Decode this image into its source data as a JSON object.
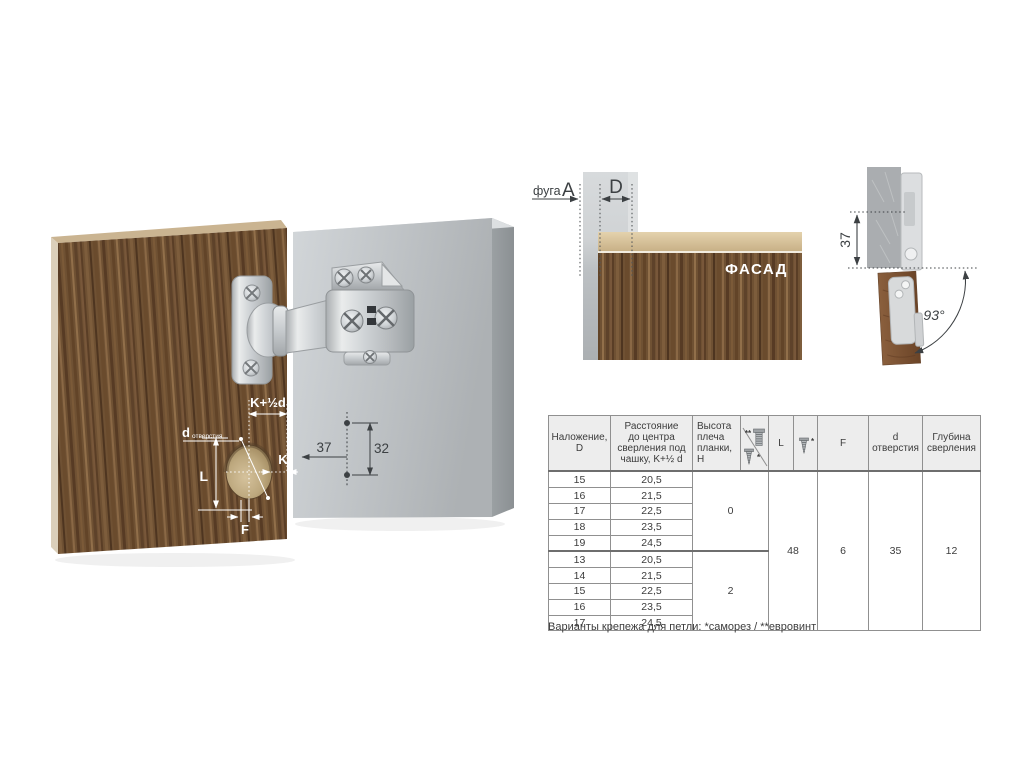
{
  "main_illustration": {
    "door_dims": {
      "k_plus_half_d": "K+½d",
      "d_label": "d",
      "d_sub": "отверстия",
      "l": "L",
      "k": "K",
      "f": "F"
    },
    "panel_dims": {
      "horizontal": "37",
      "vertical": "32"
    }
  },
  "overlay_diagram": {
    "gap_word": "фуга",
    "gap_letter": "A",
    "overlay_letter": "D",
    "facade_label": "ФАСАД"
  },
  "side_diagram": {
    "height": "37",
    "opening_angle": "93°"
  },
  "table": {
    "headers": {
      "overlay": "Наложение,\nD",
      "distance": "Расстояние\nдо центра\nсверления под\nчашку, K+½ d",
      "arm_height": "Высота\nплеча\nпланки, H",
      "l": "L",
      "f": "F",
      "hole_d": "d\nотверстия",
      "depth": "Глубина\nсверления",
      "euro_mark": "**",
      "screw_mark": "*",
      "screw_mark2": "*"
    },
    "shared": {
      "l": "48",
      "f": "6",
      "hole_d": "35",
      "depth": "12"
    },
    "groups": [
      {
        "arm_height": "0",
        "rows": [
          {
            "d": "15",
            "k": "20,5"
          },
          {
            "d": "16",
            "k": "21,5"
          },
          {
            "d": "17",
            "k": "22,5"
          },
          {
            "d": "18",
            "k": "23,5"
          },
          {
            "d": "19",
            "k": "24,5"
          }
        ]
      },
      {
        "arm_height": "2",
        "rows": [
          {
            "d": "13",
            "k": "20,5"
          },
          {
            "d": "14",
            "k": "21,5"
          },
          {
            "d": "15",
            "k": "22,5"
          },
          {
            "d": "16",
            "k": "23,5"
          },
          {
            "d": "17",
            "k": "24,5"
          }
        ]
      }
    ]
  },
  "footnote": "Варианты крепежа для петли: *саморез / **евровинт",
  "colors": {
    "wood_base": "#6f5133",
    "panel_gray": "#b9bdc0",
    "metal": "#cfd3d6",
    "table_header_bg": "#ededed",
    "dim_dark": "#3c4043",
    "dim_light": "#ffffff"
  }
}
